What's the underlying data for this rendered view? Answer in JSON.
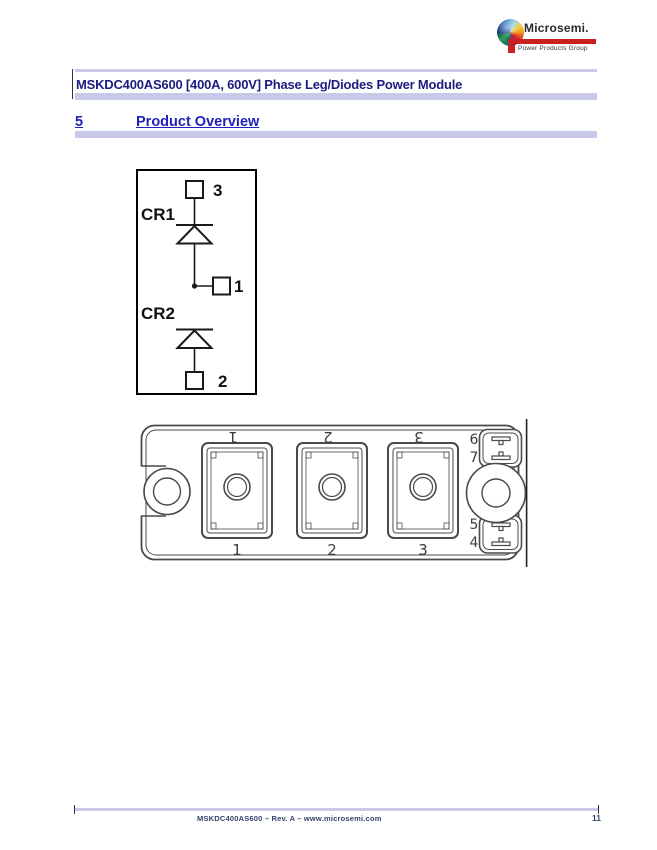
{
  "logo": {
    "brand": "Microsemi.",
    "tagline": "Power Products Group"
  },
  "header": {
    "title": "MSKDC400AS600 [400A, 600V] Phase Leg/Diodes Power Module"
  },
  "section": {
    "number": "5",
    "title": "Product Overview"
  },
  "figures": {
    "schematic": {
      "diode_top_label": "CR1",
      "diode_bottom_label": "CR2",
      "terminal_top": "3",
      "terminal_mid": "1",
      "terminal_bottom": "2"
    },
    "module": {
      "terminal_labels_top": [
        "1",
        "2",
        "3"
      ],
      "terminal_labels_bottom": [
        "1",
        "2",
        "3"
      ],
      "pin_labels": {
        "top": [
          "6",
          "7"
        ],
        "bottom": [
          "5",
          "4"
        ]
      }
    }
  },
  "footer": {
    "text": "MSKDC400AS600 – Rev. A – www.microsemi.com",
    "page_number": "11"
  },
  "colors": {
    "accent_lavender": "#c8c8e8",
    "title_navy": "#1b1b80",
    "link_blue": "#2121bd",
    "brand_red": "#cc1f1f"
  }
}
